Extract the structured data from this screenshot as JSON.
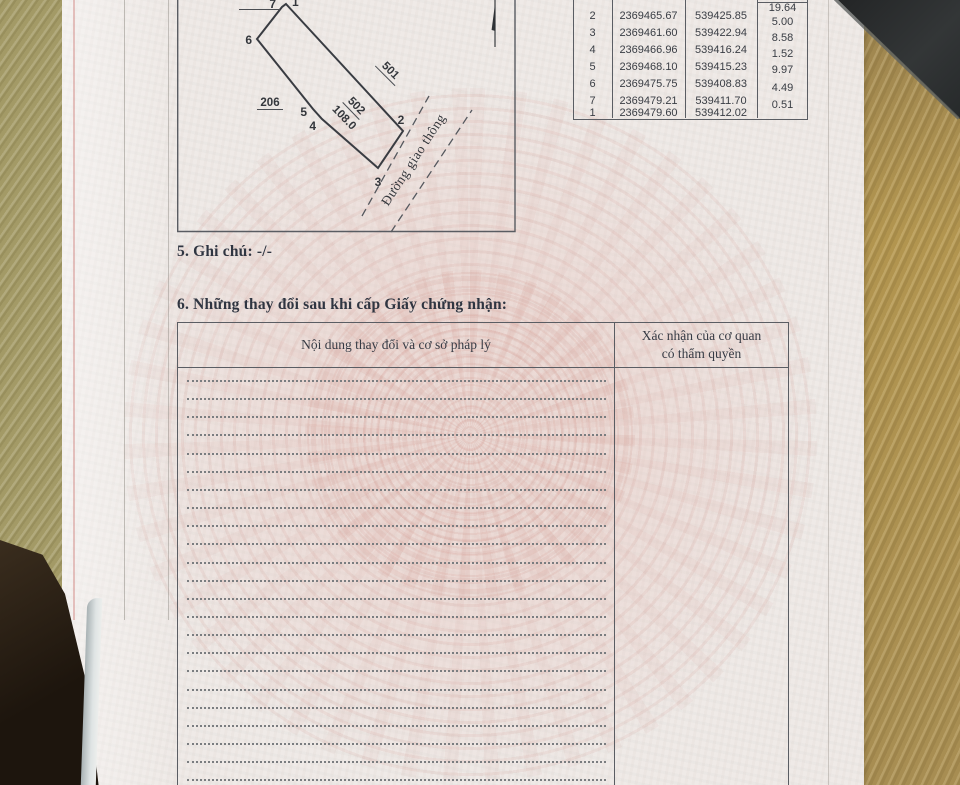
{
  "sections": {
    "note": "5. Ghi chú: -/-",
    "changes_title": "6. Những thay đổi sau khi cấp Giấy chứng nhận:"
  },
  "changes_table": {
    "col1_header": "Nội dung thay đổi và cơ sở pháp lý",
    "col2_header_line1": "Xác nhận của cơ quan",
    "col2_header_line2": "có thẩm quyền",
    "dotted_line_count": 23
  },
  "coordinate_table": {
    "rows": [
      {
        "point": "1",
        "x": "2369479.60",
        "y": "539412.02"
      },
      {
        "point": "2",
        "x": "2369465.67",
        "y": "539425.85"
      },
      {
        "point": "3",
        "x": "2369461.60",
        "y": "539422.94"
      },
      {
        "point": "4",
        "x": "2369466.96",
        "y": "539416.24"
      },
      {
        "point": "5",
        "x": "2369468.10",
        "y": "539415.23"
      },
      {
        "point": "6",
        "x": "2369475.75",
        "y": "539408.83"
      },
      {
        "point": "7",
        "x": "2369479.21",
        "y": "539411.70"
      },
      {
        "point": "1",
        "x": "2369479.60",
        "y": "539412.02"
      }
    ],
    "edge_lengths": [
      "19.64",
      "5.00",
      "8.58",
      "1.52",
      "9.97",
      "4.49",
      "0.51"
    ]
  },
  "map": {
    "parcel_number": "502",
    "parcel_area": "108.0",
    "neighbor_parcel_ne": "501",
    "neighbor_parcel_w": "206",
    "road_label": "Đường giao thông",
    "vertices": {
      "v1": "1",
      "v2": "2",
      "v3": "3",
      "v4": "4",
      "v5": "5",
      "v6": "6",
      "v7": "7"
    }
  },
  "colors": {
    "page_bg": "#efeae7",
    "ink": "#34383f",
    "table_border": "#5a5d63",
    "watermark_pink": "#e6c0b9",
    "desk_wood": "#ab8f50"
  }
}
